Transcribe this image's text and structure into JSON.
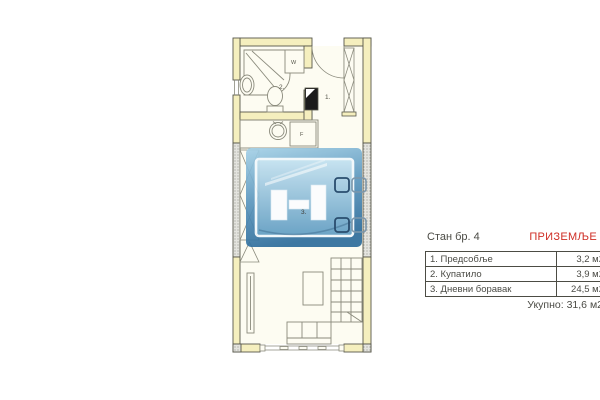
{
  "plan": {
    "room_labels": [
      {
        "id": "hallway",
        "label": "1."
      },
      {
        "id": "bathroom",
        "label": "2."
      },
      {
        "id": "living-room",
        "label": "3."
      }
    ],
    "fixture_labels": {
      "washing_machine": "W",
      "fridge": "F"
    }
  },
  "info": {
    "title": "Стан бр. 4",
    "floor": "ПРИЗЕМЉЕ",
    "table": {
      "rows": [
        {
          "name": "1. Предсобље",
          "area": "3,2 м2"
        },
        {
          "name": "2. Купатило",
          "area": "3,9 м2"
        },
        {
          "name": "3. Дневни боравак",
          "area": "24,5 м2"
        }
      ]
    },
    "total": "Укупно: 31,6 м2"
  },
  "colors": {
    "wall_fill": "#f5efbe",
    "wall_stroke": "#57574a",
    "shared_wall_gray": "#e2e2dd",
    "furniture_stroke": "#8a8a7c",
    "accent_red": "#cf2d24",
    "text": "#4b4b45",
    "watermark_top": "#9cc9e2",
    "watermark_bottom": "#2e6d9c",
    "chair_dark": "#2a4d6e"
  }
}
